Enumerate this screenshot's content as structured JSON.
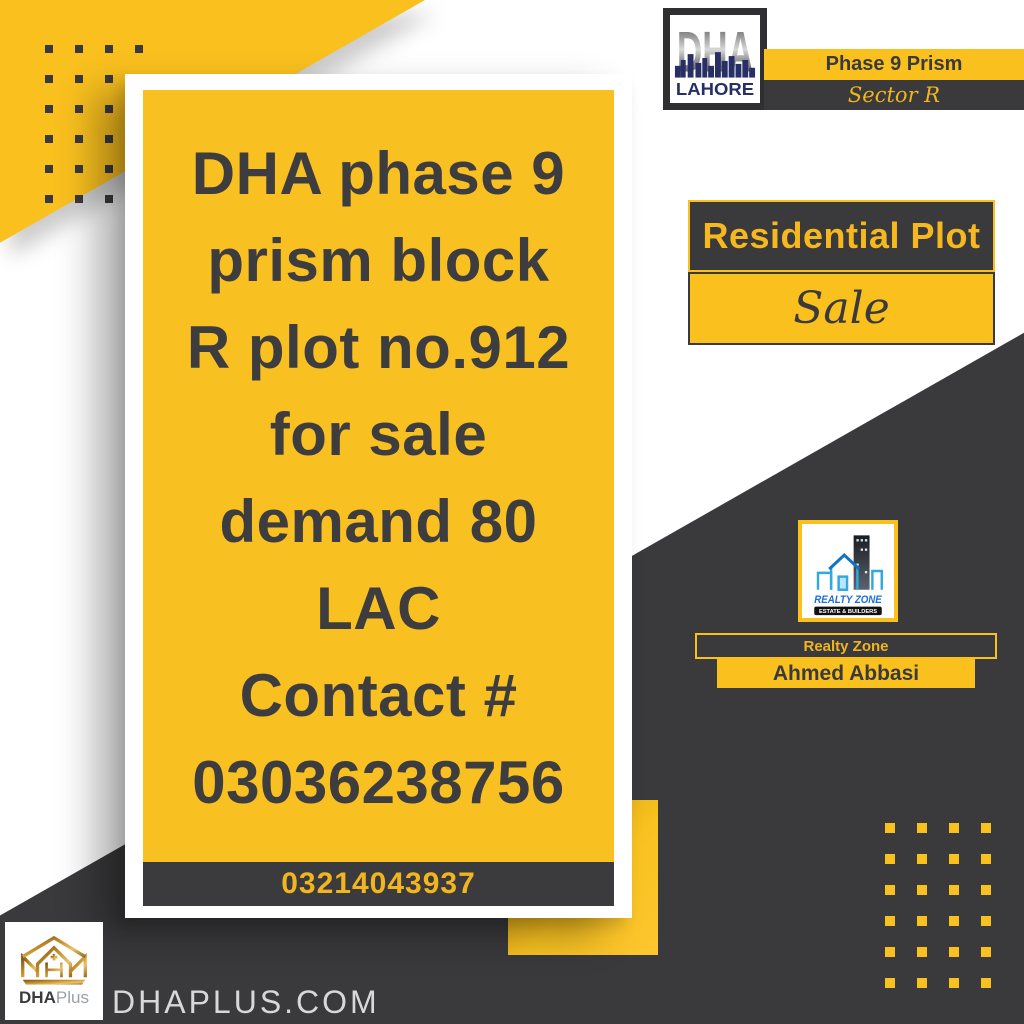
{
  "header": {
    "dha_logo": {
      "title": "DHA",
      "subtitle": "LAHORE"
    },
    "phase_label": "Phase 9 Prism",
    "sector_label": "Sector R"
  },
  "listing": {
    "type_label": "Residential Plot",
    "status_label": "Sale"
  },
  "main_card": {
    "lines": [
      "DHA phase 9",
      "prism block",
      "R plot no.912",
      "for sale",
      "demand 80",
      "LAC",
      "Contact #",
      "03036238756"
    ],
    "footer_phone": "03214043937"
  },
  "agent": {
    "logo_name": "REALTY ZONE",
    "logo_tagline": "ESTATE & BUILDERS",
    "company": "Realty Zone",
    "name": "Ahmed Abbasi"
  },
  "branding": {
    "logo_text_bold": "DHA",
    "logo_text_light": "Plus",
    "website": "DHAPLUS.COM"
  },
  "colors": {
    "yellow": "#F9C01E",
    "charcoal": "#3A3A3C",
    "card_text": "#3D3D40",
    "phone_yellow": "#F2B51D",
    "navy": "#272F66",
    "realty_blue": "#1D6FD2",
    "gold": "#C89B3C",
    "website_gray": "#D8D8D8",
    "pattern_dark_dots": "#3A3A3C",
    "pattern_yellow_dots": "#F9C01E"
  }
}
